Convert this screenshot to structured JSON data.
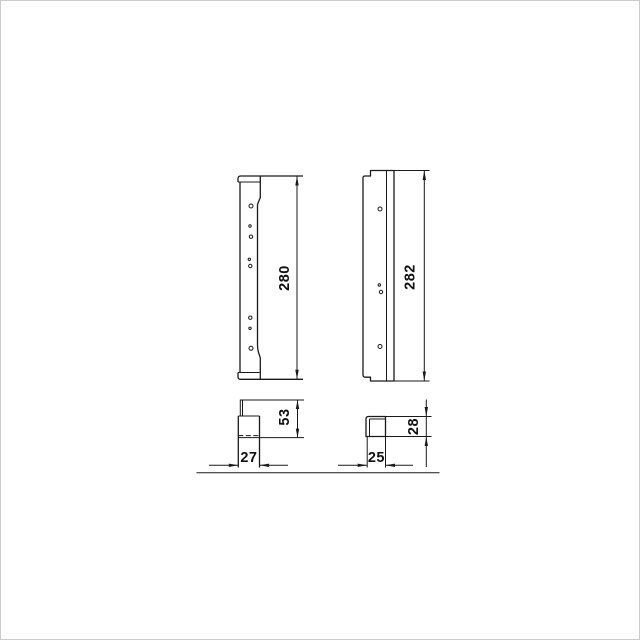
{
  "canvas": {
    "background": "#ffffff",
    "frame_color": "#cccccc",
    "line_color": "#1a1a1a",
    "text_color": "#111111"
  },
  "dimensions": {
    "left_profile_height": "280",
    "right_profile_height": "282",
    "left_section_height": "53",
    "left_section_width": "27",
    "right_section_height": "28",
    "right_section_width": "25"
  }
}
